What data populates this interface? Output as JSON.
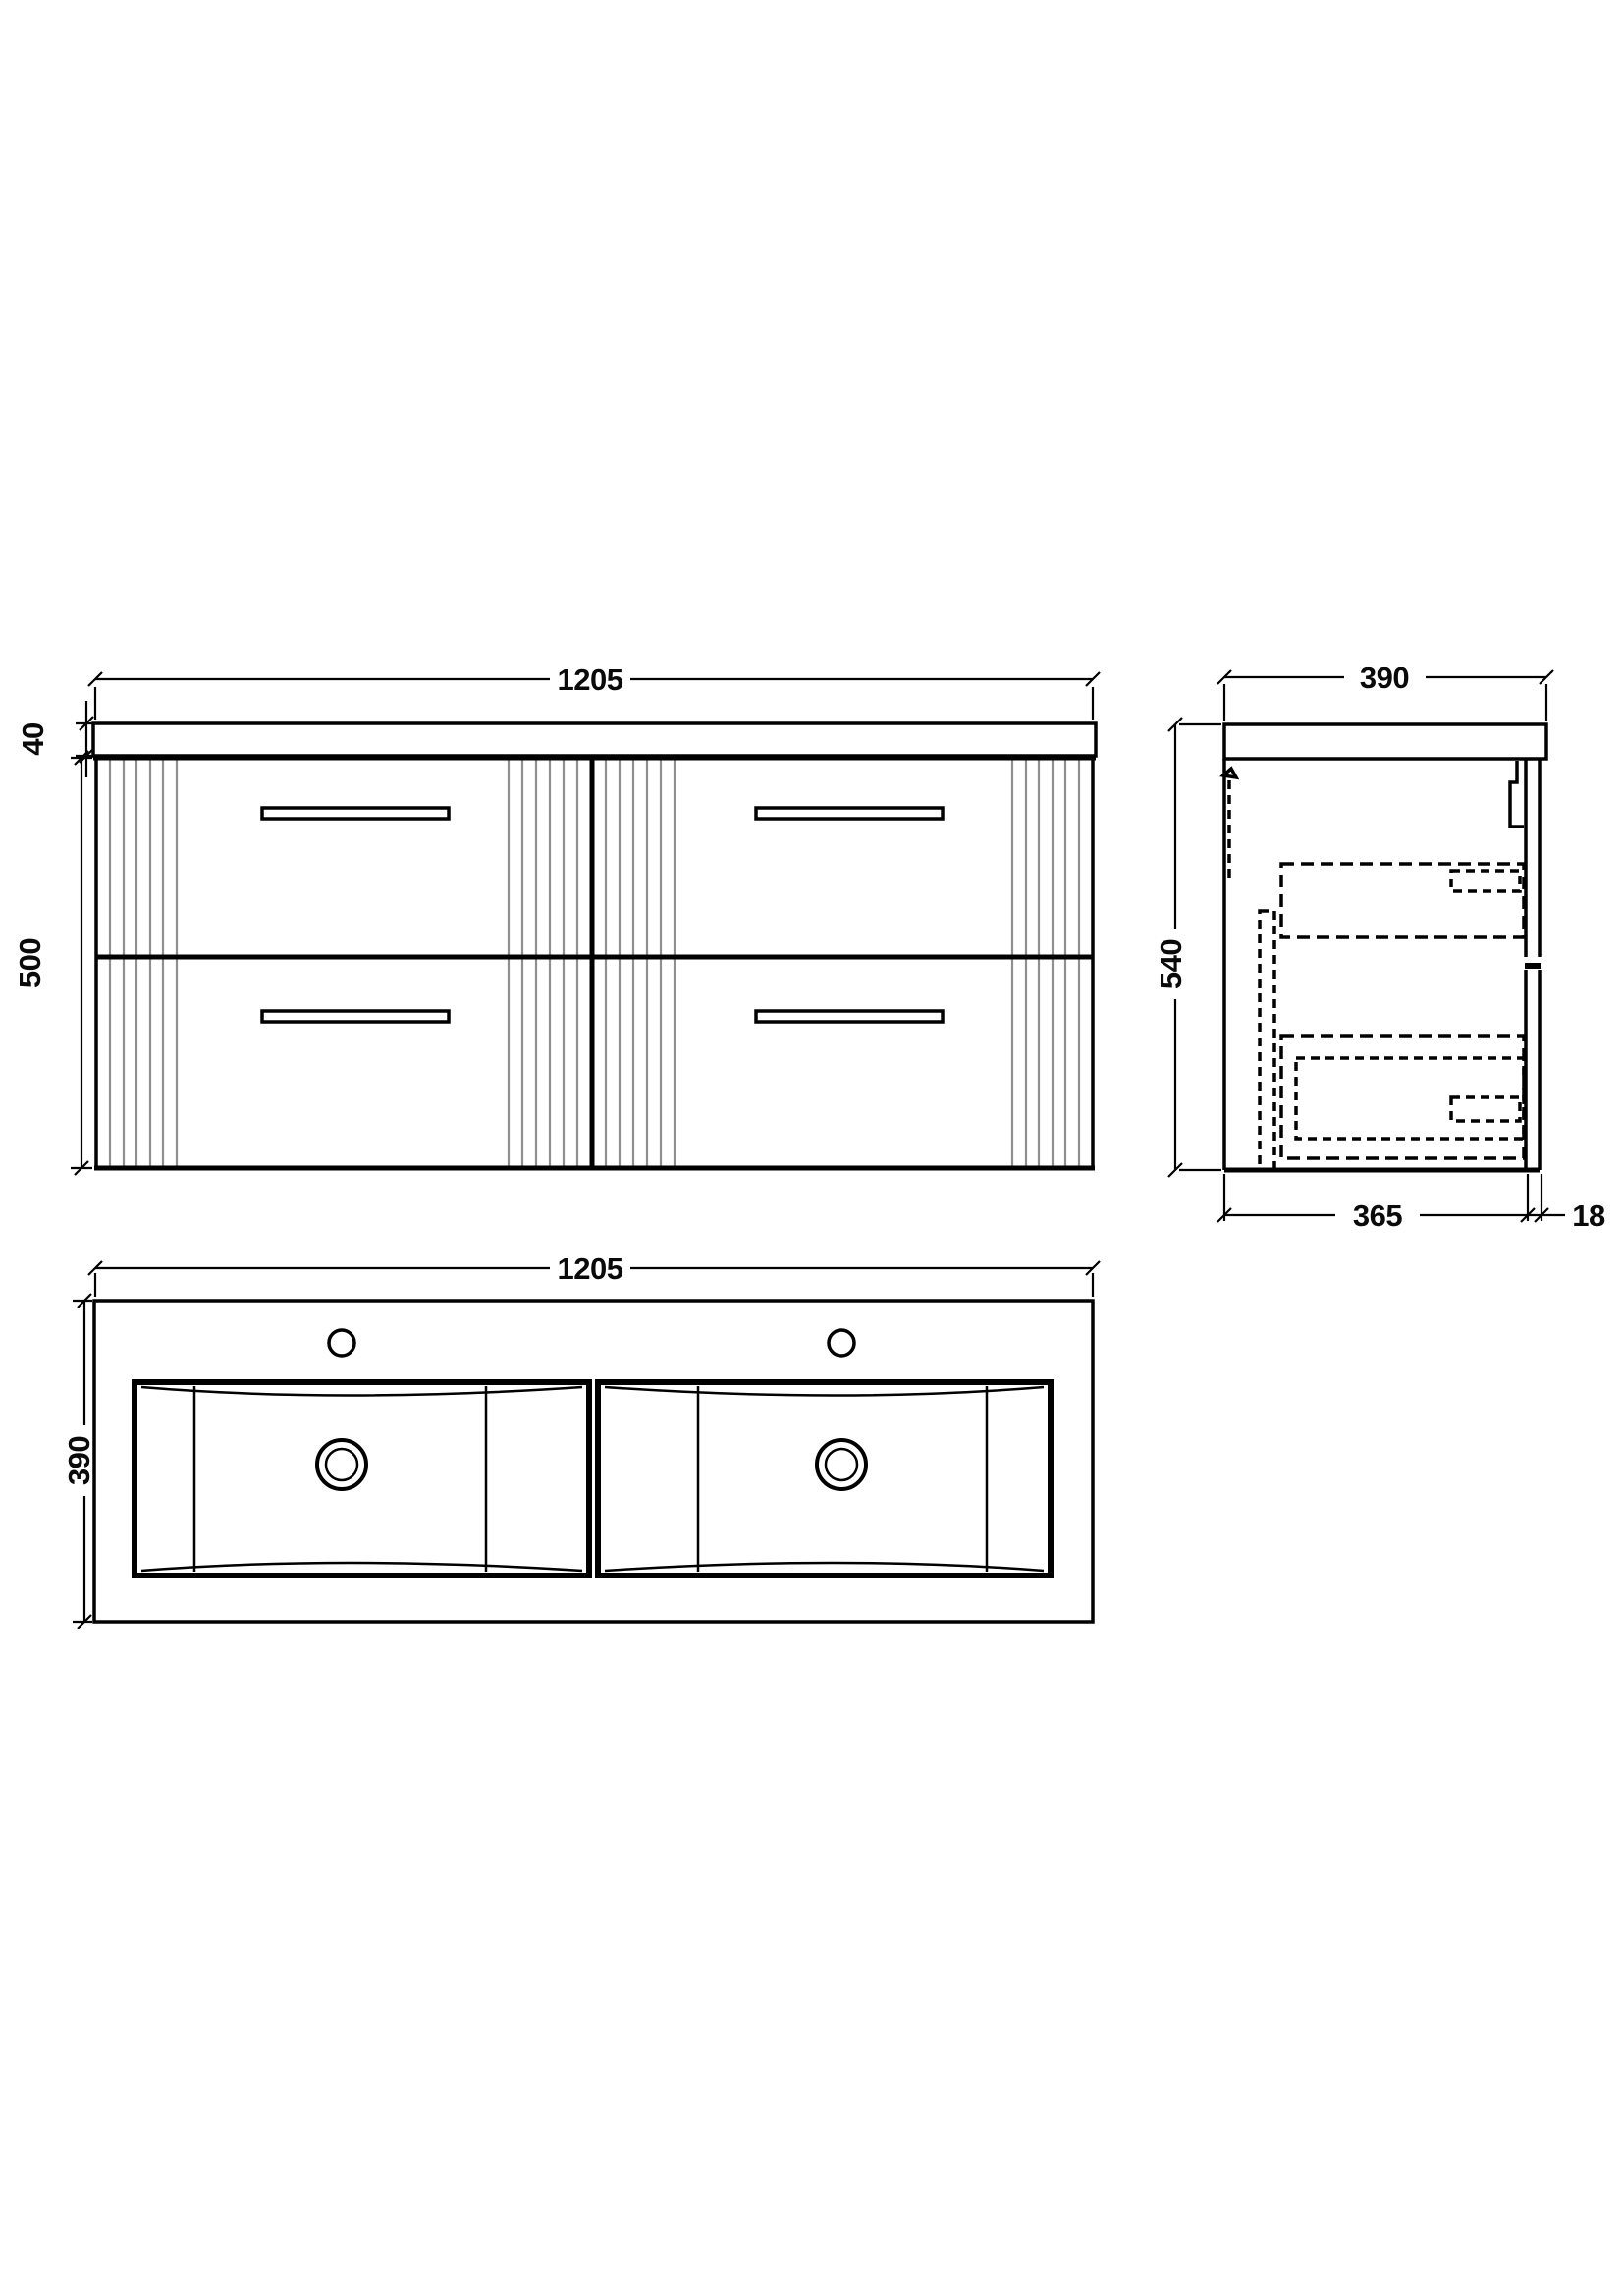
{
  "drawing": {
    "type": "technical-dimension-drawing",
    "subject": "wall-hung 4-drawer double basin vanity unit",
    "line_color": "#000000",
    "flute_color": "#8f8f8f",
    "background": "#ffffff"
  },
  "views": {
    "front": {
      "title": "front-elevation",
      "width_mm": "1205",
      "worktop_thickness_mm": "40",
      "cabinet_height_mm": "500"
    },
    "side": {
      "title": "side-elevation",
      "depth_mm": "390",
      "overall_height_mm": "540",
      "cabinet_depth_mm": "365",
      "front_panel_mm": "18"
    },
    "plan": {
      "title": "plan-view",
      "width_mm": "1205",
      "depth_mm": "390"
    }
  }
}
